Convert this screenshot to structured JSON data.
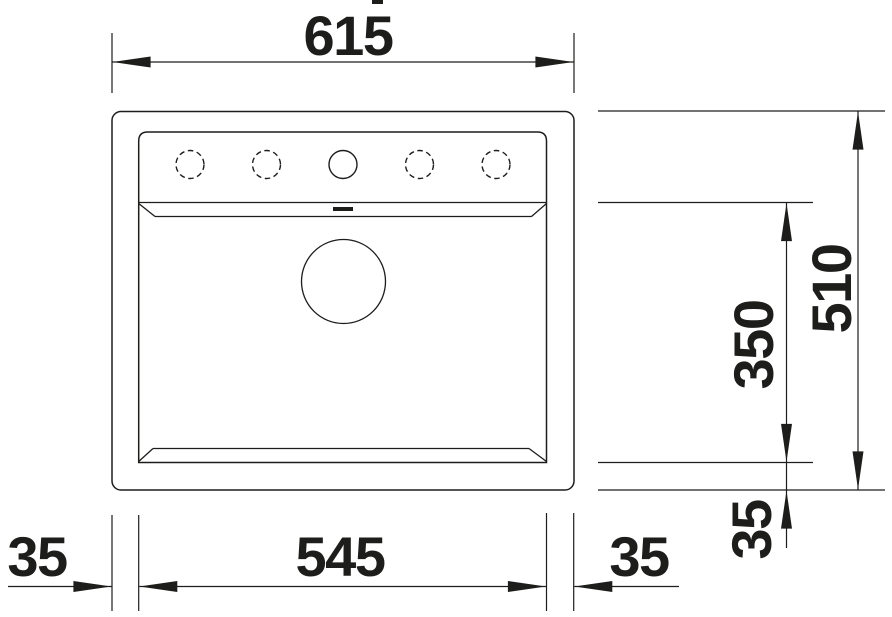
{
  "drawing": {
    "title": "sink-plan-technical-drawing",
    "background": "#ffffff",
    "line_color": "#1d1d1b",
    "dimensions": {
      "overall_width": "615",
      "overall_depth": "510",
      "bowl_depth": "350",
      "bowl_width": "545",
      "rim_left": "35",
      "rim_right": "35",
      "rim_bottom": "35"
    },
    "features": {
      "tap_holes": [
        "dashed",
        "dashed",
        "solid",
        "dashed",
        "dashed"
      ],
      "drain": "drain-circle",
      "overflow": "overflow-slot"
    }
  }
}
